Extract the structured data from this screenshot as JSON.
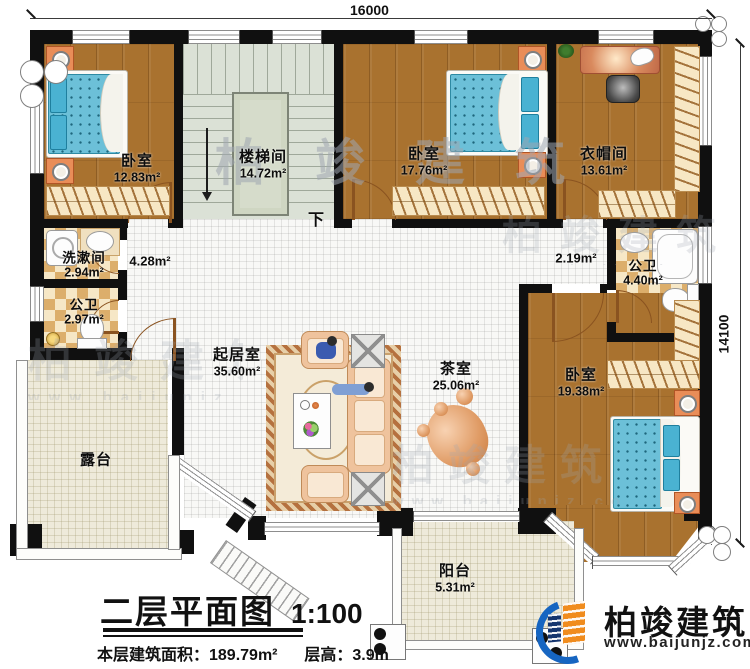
{
  "dimensions": {
    "top": "16000",
    "right": "14100"
  },
  "rooms": {
    "bedroom1": {
      "name": "卧室",
      "area": "12.83m²"
    },
    "stairwell": {
      "name": "楼梯间",
      "area": "14.72m²"
    },
    "bedroom2": {
      "name": "卧室",
      "area": "17.76m²"
    },
    "cloakroom": {
      "name": "衣帽间",
      "area": "13.61m²"
    },
    "washroom": {
      "name": "洗漱间",
      "area": "2.94m²"
    },
    "bath_left": {
      "name": "公卫",
      "area": "2.97m²"
    },
    "bath_right": {
      "name": "公卫",
      "area": "4.40m²"
    },
    "living_room": {
      "name": "起居室",
      "area": "35.60m²"
    },
    "tea_room": {
      "name": "茶室",
      "area": "25.06m²"
    },
    "bedroom3": {
      "name": "卧室",
      "area": "19.38m²"
    },
    "terrace": {
      "name": "露台"
    },
    "balcony": {
      "name": "阳台",
      "area": "5.31m²"
    }
  },
  "annotations": {
    "hall_area": "4.28m²",
    "corridor_area": "2.19m²",
    "stair_down": "下"
  },
  "title_block": {
    "title": "二层平面图",
    "scale": "1:100",
    "area_text": "本层建筑面积：189.79m²",
    "height_text": "层高：3.9m"
  },
  "branding": {
    "company": "柏竣建筑",
    "website": "www.baijunjz.com"
  },
  "colors": {
    "wall": "#101010",
    "wood_floor": "#a9722f",
    "mattress_blue": "#6cc0d8",
    "accent_orange": "#f08c1e",
    "accent_blue": "#1665c1",
    "checker_tan": "#dcae6b"
  }
}
